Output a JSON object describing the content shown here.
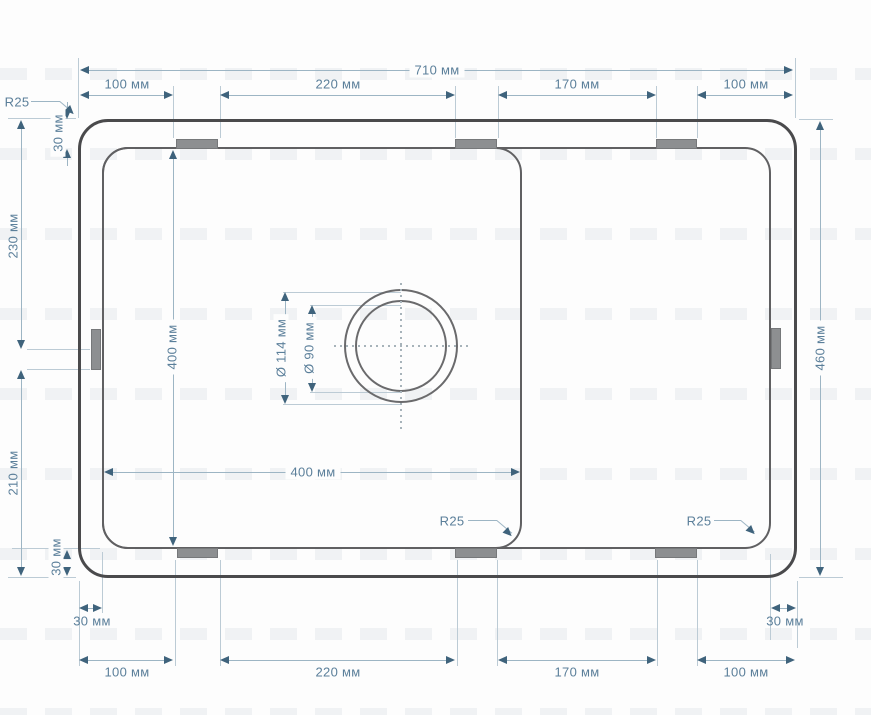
{
  "meta": {
    "drawing_type": "sink top-view technical drawing",
    "units": "мм"
  },
  "dims": {
    "total_width": "710 мм",
    "total_depth": "460 мм",
    "top_seg1": "100 мм",
    "top_seg2": "220 мм",
    "top_seg3": "170 мм",
    "top_seg4": "100 мм",
    "bottom_seg1": "100 мм",
    "bottom_seg2": "220 мм",
    "bottom_seg3": "170 мм",
    "bottom_seg4": "100 мм",
    "left_upper": "230 мм",
    "left_lower": "210 мм",
    "edge_top_left": "30 мм",
    "edge_bottom_left_v": "30 мм",
    "edge_bottom_left_h": "30 мм",
    "edge_bottom_right_h": "30 мм",
    "bowl_width": "400 мм",
    "bowl_depth": "400 мм",
    "drain_outer": "Ø 114 мм",
    "drain_inner": "Ø 90 мм",
    "radius_outer": "R25",
    "radius_bowl": "R25",
    "radius_rim": "R25"
  },
  "colors": {
    "outer_outline": "#4a4a4c",
    "inner_outline": "#606062",
    "dim_line": "#9db5c4",
    "extension_line": "#bccbd5",
    "arrow": "#3f637c",
    "dim_text": "#5b7f9a",
    "tab_fill": "#8d8f91",
    "background": "#fdfdfd"
  }
}
